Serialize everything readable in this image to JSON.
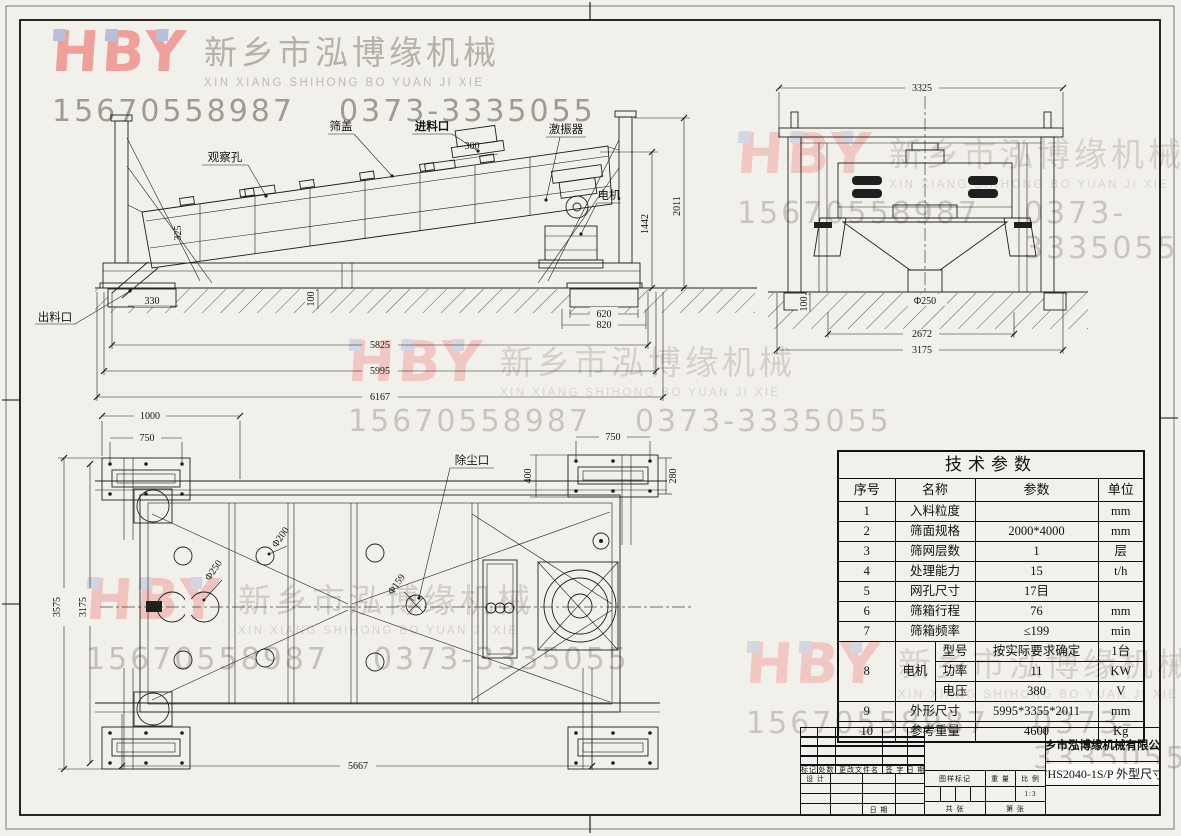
{
  "watermark": {
    "logo": "HBY",
    "company_cn": "新乡市泓博缘机械",
    "company_en": "XIN XIANG SHIHONG BO YUAN JI XIE",
    "phone1": "15670558987",
    "phone2": "0373-3335055"
  },
  "side_view": {
    "labels": {
      "observe_hole": "观察孔",
      "screen_cover": "筛盖",
      "feed_inlet": "进料口",
      "exciter": "激振器",
      "motor": "电机",
      "discharge_outlet": "出料口"
    },
    "dims": {
      "d300": "300",
      "d325": "325",
      "d100": "100",
      "d330": "330",
      "d620": "620",
      "d820": "820",
      "d1442": "1442",
      "d2011": "2011",
      "d5825": "5825",
      "d5995": "5995",
      "d6167": "6167"
    }
  },
  "end_view": {
    "dims": {
      "d3325": "3325",
      "d250": "Φ250",
      "d100": "100",
      "d2672": "2672",
      "d3175": "3175"
    }
  },
  "top_view": {
    "labels": {
      "dust_port": "除尘口"
    },
    "dims": {
      "d1000": "1000",
      "d750_left": "750",
      "d750_right": "750",
      "d400": "400",
      "d280": "280",
      "d3575": "3575",
      "d3175": "3175",
      "d5667": "5667",
      "d250": "Φ250",
      "d200": "Φ200",
      "d159": "Φ159"
    }
  },
  "params_table": {
    "title": "技术参数",
    "headers": [
      "序号",
      "名称",
      "参数",
      "单位"
    ],
    "rows": [
      {
        "no": "1",
        "name": "入料粒度",
        "value": "",
        "unit": "mm"
      },
      {
        "no": "2",
        "name": "筛面规格",
        "value": "2000*4000",
        "unit": "mm"
      },
      {
        "no": "3",
        "name": "筛网层数",
        "value": "1",
        "unit": "层"
      },
      {
        "no": "4",
        "name": "处理能力",
        "value": "15",
        "unit": "t/h"
      },
      {
        "no": "5",
        "name": "网孔尺寸",
        "value": "17目",
        "unit": ""
      },
      {
        "no": "6",
        "name": "筛箱行程",
        "value": "76",
        "unit": "mm"
      },
      {
        "no": "7",
        "name": "筛箱频率",
        "value": "≤199",
        "unit": "min"
      }
    ],
    "motor": {
      "no": "8",
      "name": "电机",
      "sub": [
        {
          "key": "型号",
          "value": "按实际要求确定",
          "unit": "1台"
        },
        {
          "key": "功率",
          "value": "11",
          "unit": "KW"
        },
        {
          "key": "电压",
          "value": "380",
          "unit": "V"
        }
      ]
    },
    "rows_b": [
      {
        "no": "9",
        "name": "外形尺寸",
        "value": "5995*3355*2011",
        "unit": "mm"
      },
      {
        "no": "10",
        "name": "参考重量",
        "value": "4600",
        "unit": "Kg"
      }
    ]
  },
  "title_block": {
    "company": "新乡市泓博缘机械有限公司",
    "drawing_no": "FHS2040-1S/P  外型尺寸",
    "labels": {
      "mark": "标记",
      "count": "处数",
      "change_doc": "更改文件名",
      "sign": "签 字",
      "date": "日 期",
      "design": "设 计",
      "date2": "日 期",
      "drawing_mark": "图样标记",
      "weight": "重 量",
      "scale": "比 例",
      "scale_value": "1:3",
      "sheet_total": "共  张",
      "sheet_no": "第  张"
    }
  }
}
